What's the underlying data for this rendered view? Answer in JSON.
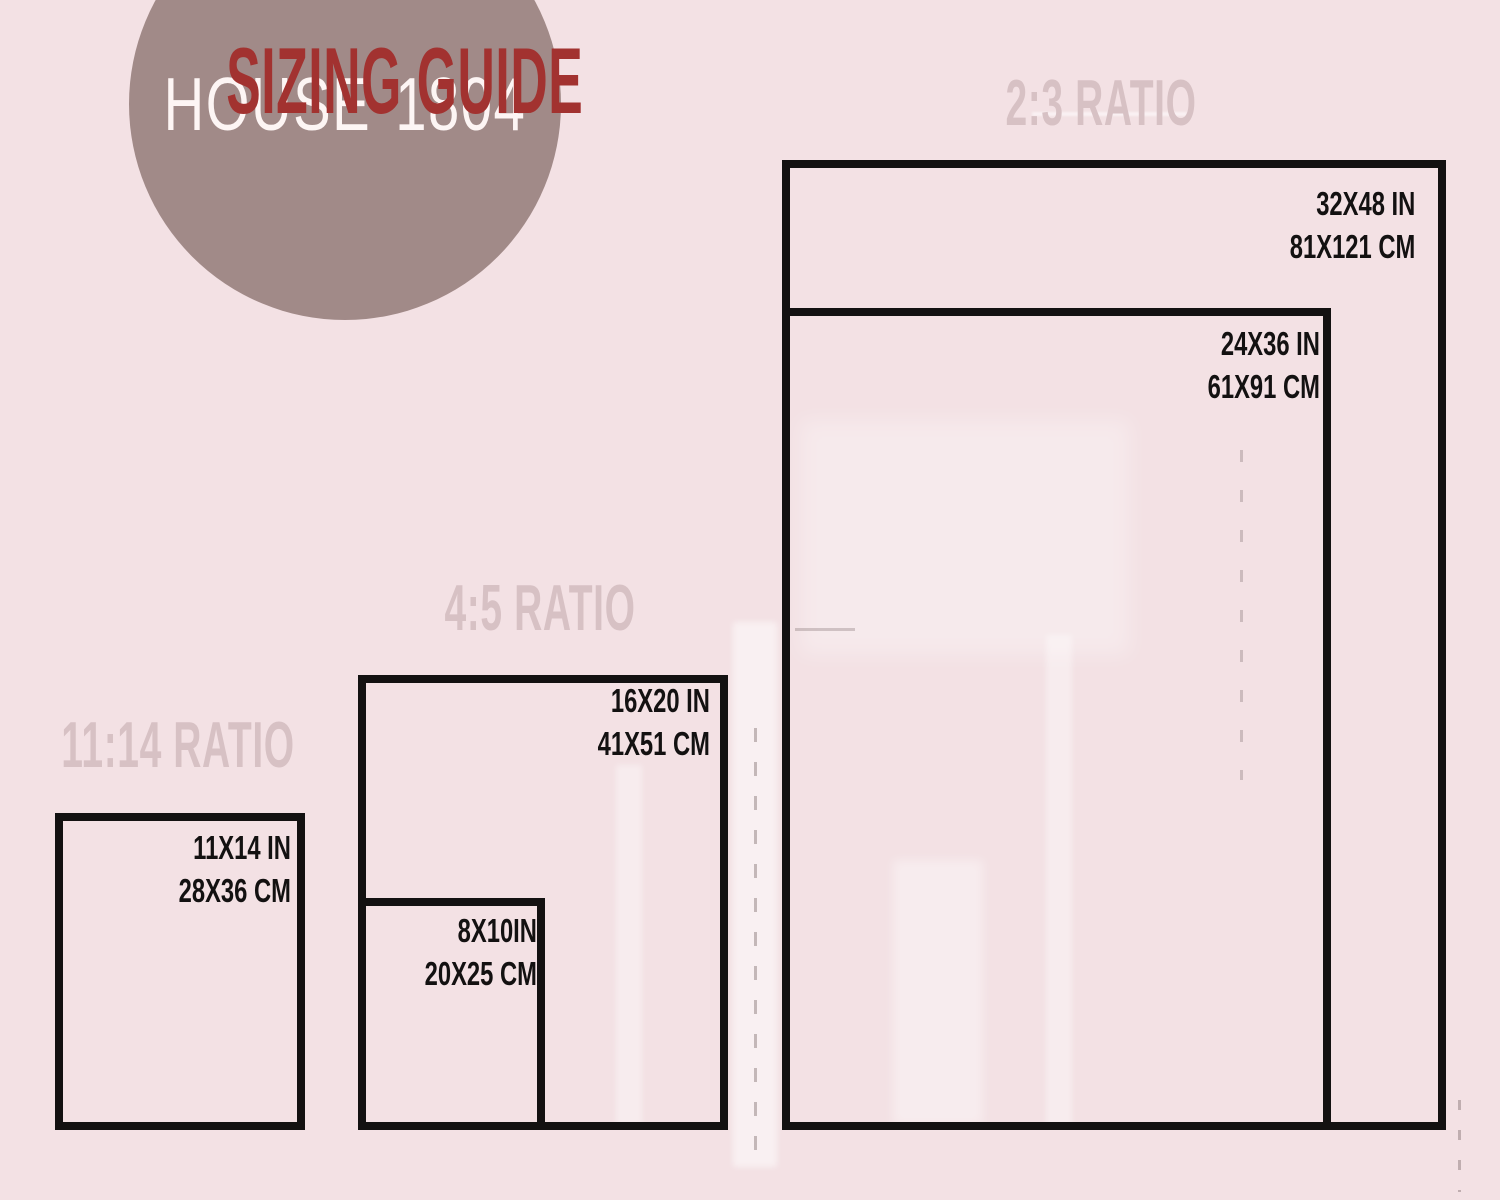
{
  "logo": {
    "brand_left": "HOUSE",
    "brand_right": "1804",
    "subtitle": "SIZING GUIDE"
  },
  "colors": {
    "background": "#f3e1e4",
    "circle": "#a18a88",
    "brand_text": "#fdf5f4",
    "subtitle": "#a23230",
    "ratio_label": "#d7c1c4",
    "outline": "#131111"
  },
  "groups": [
    {
      "ratio_label": "2:3 RATIO",
      "rects": [
        {
          "size_in": "32X48 IN",
          "size_cm": "81X121 CM"
        },
        {
          "size_in": "24X36 IN",
          "size_cm": "61X91 CM"
        }
      ]
    },
    {
      "ratio_label": "4:5 RATIO",
      "rects": [
        {
          "size_in": "16X20 IN",
          "size_cm": "41X51 CM"
        },
        {
          "size_in": "8X10IN",
          "size_cm": "20X25 CM"
        }
      ]
    },
    {
      "ratio_label": "11:14 RATIO",
      "rects": [
        {
          "size_in": "11X14 IN",
          "size_cm": "28X36 CM"
        }
      ]
    }
  ]
}
